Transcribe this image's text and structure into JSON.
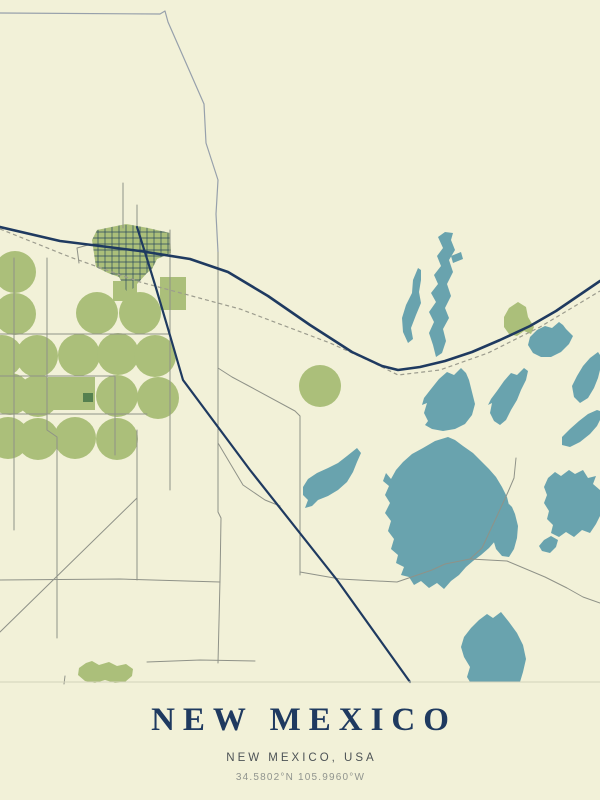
{
  "poster": {
    "title": "NEW MEXICO",
    "subtitle": "NEW MEXICO, USA",
    "coordinates": "34.5802°N 105.9960°W"
  },
  "colors": {
    "bg": "#f2f1d8",
    "lake": "#69a3ae",
    "field": "#abbf7a",
    "fieldDark": "#55804f",
    "highway": "#1f3a60",
    "railway": "#9c9c8e",
    "roadThin": "#8f9288",
    "roadFaint": "#d3d2ba",
    "boundary": "#97a0ab",
    "townGrid": "#2c4a5e",
    "title": "#1f3a60",
    "subtitle": "#4d5356",
    "coords": "#90948e"
  },
  "map": {
    "viewbox": "0 0 600 690",
    "town_path": "M92,240 L97,230 L126,224 L148,228 L170,233 L171,253 L157,259 L152,269 L147,273 L128,294 L119,277 L108,273 L96,267 Z",
    "features": [
      {
        "layer": "fields",
        "type": "path",
        "name": "town-area",
        "cls": "f-field",
        "d": "M92,240 L97,230 L126,224 L148,228 L170,233 L171,253 L157,259 L152,269 L147,273 L128,294 L119,277 L108,273 L96,267 Z"
      },
      {
        "layer": "fields",
        "type": "circle",
        "name": "crop-circle",
        "cls": "f-field",
        "cx": 15,
        "cy": 272,
        "r": 21
      },
      {
        "layer": "fields",
        "type": "circle",
        "name": "crop-circle",
        "cls": "f-field",
        "cx": 15,
        "cy": 314,
        "r": 21
      },
      {
        "layer": "fields",
        "type": "circle",
        "name": "crop-circle",
        "cls": "f-field",
        "cx": 97,
        "cy": 313,
        "r": 21
      },
      {
        "layer": "fields",
        "type": "circle",
        "name": "crop-circle",
        "cls": "f-field",
        "cx": 140,
        "cy": 313,
        "r": 21
      },
      {
        "layer": "fields",
        "type": "circle",
        "name": "crop-circle",
        "cls": "f-field",
        "cx": 2,
        "cy": 356,
        "r": 21
      },
      {
        "layer": "fields",
        "type": "circle",
        "name": "crop-circle",
        "cls": "f-field",
        "cx": 37,
        "cy": 356,
        "r": 21
      },
      {
        "layer": "fields",
        "type": "circle",
        "name": "crop-circle",
        "cls": "f-field",
        "cx": 79,
        "cy": 355,
        "r": 21
      },
      {
        "layer": "fields",
        "type": "circle",
        "name": "crop-circle",
        "cls": "f-field",
        "cx": 118,
        "cy": 354,
        "r": 21
      },
      {
        "layer": "fields",
        "type": "circle",
        "name": "crop-circle",
        "cls": "f-field",
        "cx": 155,
        "cy": 356,
        "r": 21
      },
      {
        "layer": "fields",
        "type": "circle",
        "name": "crop-circle",
        "cls": "f-field",
        "cx": 10,
        "cy": 394,
        "r": 21
      },
      {
        "layer": "fields",
        "type": "circle",
        "name": "crop-circle",
        "cls": "f-field",
        "cx": 38,
        "cy": 396,
        "r": 21
      },
      {
        "layer": "fields",
        "type": "circle",
        "name": "crop-circle",
        "cls": "f-field",
        "cx": 117,
        "cy": 396,
        "r": 21
      },
      {
        "layer": "fields",
        "type": "circle",
        "name": "crop-circle",
        "cls": "f-field",
        "cx": 158,
        "cy": 398,
        "r": 21
      },
      {
        "layer": "fields",
        "type": "circle",
        "name": "crop-circle",
        "cls": "f-field",
        "cx": 8,
        "cy": 438,
        "r": 21
      },
      {
        "layer": "fields",
        "type": "circle",
        "name": "crop-circle",
        "cls": "f-field",
        "cx": 38,
        "cy": 439,
        "r": 21
      },
      {
        "layer": "fields",
        "type": "circle",
        "name": "crop-circle",
        "cls": "f-field",
        "cx": 75,
        "cy": 438,
        "r": 21
      },
      {
        "layer": "fields",
        "type": "circle",
        "name": "crop-circle",
        "cls": "f-field",
        "cx": 117,
        "cy": 439,
        "r": 21
      },
      {
        "layer": "fields",
        "type": "circle",
        "name": "crop-circle",
        "cls": "f-field",
        "cx": 320,
        "cy": 386,
        "r": 21
      },
      {
        "layer": "fields",
        "type": "path",
        "name": "field-patch",
        "cls": "f-field",
        "d": "M48,377 H95 V410 H48 Z"
      },
      {
        "layer": "fields",
        "type": "path",
        "name": "field-patch",
        "cls": "f-field",
        "d": "M160,277 H186 V310 H160 Z"
      },
      {
        "layer": "fields",
        "type": "path",
        "name": "field-patch",
        "cls": "f-field",
        "d": "M113,281 H137 V301 H113 Z"
      },
      {
        "layer": "fields",
        "type": "path",
        "name": "field-patch",
        "cls": "f-field",
        "d": "M518,302 L509,308 L504,317 L504,327 L509,334 L517,336 L524,331 L531,334 L534,327 L528,317 L526,307 Z"
      },
      {
        "layer": "fields",
        "type": "path",
        "name": "field-patch",
        "cls": "f-field",
        "d": "M86,663 L79,668 L78,675 L85,681 L95,683 L105,680 L115,683 L125,682 L132,676 L133,669 L126,664 L117,666 L109,662 L99,665 L92,661 Z"
      },
      {
        "layer": "fields",
        "type": "path",
        "name": "field-patch-dark",
        "cls": "f-fielddark",
        "d": "M83,393 H93 V402 H83 Z"
      },
      {
        "layer": "grid",
        "type": "path",
        "name": "town-street-grid",
        "cls": "s-grid",
        "clip": true,
        "d": "M98,225 V296 M105,225 V296 M112,225 V296 M119,225 V296 M126,225 V296 M133,225 V296 M140,225 V296 M147,225 V296 M154,225 V296 M161,225 V296 M168,225 V296 M90,232 H174 M90,238 H174 M90,244 H174 M90,250 H174 M90,256 H174 M90,262 H174 M90,268 H174 M90,274 H174 M90,280 H174"
      },
      {
        "layer": "lakes",
        "type": "path",
        "name": "lake",
        "cls": "f-lake",
        "d": "M418,268 L413,280 L412,293 L406,305 L402,318 L403,332 L408,343 L413,339 L411,328 L416,315 L421,303 L419,292 L421,280 L421,270 Z"
      },
      {
        "layer": "lakes",
        "type": "path",
        "name": "lake",
        "cls": "f-lake",
        "d": "M445,232 L438,237 L443,248 L437,256 L441,266 L434,275 L438,284 L431,293 L436,302 L429,312 L434,322 L429,333 L433,345 L436,357 L442,353 L446,341 L443,329 L449,318 L445,308 L451,296 L447,284 L453,272 L449,260 L455,250 L451,240 L453,233 Z"
      },
      {
        "layer": "lakes",
        "type": "path",
        "name": "lake",
        "cls": "f-lake",
        "d": "M451,256 L461,252 L463,259 L453,263 Z"
      },
      {
        "layer": "lakes",
        "type": "path",
        "name": "lake",
        "cls": "f-lake",
        "d": "M461,368 L454,375 L447,372 L439,379 L431,389 L424,398 L422,405 L427,403 L424,413 L428,421 L425,425 L432,429 L443,431 L455,429 L465,424 L472,415 L475,404 L472,392 L469,380 L466,373 Z"
      },
      {
        "layer": "lakes",
        "type": "path",
        "name": "lake",
        "cls": "f-lake",
        "d": "M524,368 L517,375 L511,373 L504,381 L497,391 L491,399 L488,405 L492,403 L490,413 L494,421 L500,425 L506,420 L511,410 L517,400 L521,390 L526,380 L528,371 Z"
      },
      {
        "layer": "lakes",
        "type": "path",
        "name": "lake",
        "cls": "f-lake",
        "d": "M559,322 L552,328 L545,326 L537,330 L530,337 L528,345 L533,353 L541,357 L551,357 L561,352 L569,344 L573,336 L566,329 L563,325 Z"
      },
      {
        "layer": "lakes",
        "type": "path",
        "name": "lake",
        "cls": "f-lake",
        "d": "M598,352 L590,358 L583,366 L577,376 L572,386 L574,397 L580,403 L588,398 L594,388 L598,378 L600,370 L600,355 Z"
      },
      {
        "layer": "lakes",
        "type": "path",
        "name": "lake",
        "cls": "f-lake",
        "d": "M597,410 L588,414 L579,421 L570,429 L562,437 L562,445 L570,447 L580,442 L590,434 L597,426 L600,420 L600,411 Z"
      },
      {
        "layer": "lakes",
        "type": "path",
        "name": "lake",
        "cls": "f-lake",
        "d": "M357,448 L347,456 L338,463 L328,468 L317,473 L308,479 L303,487 L303,495 L308,500 L305,508 L312,506 L318,500 L328,496 L338,490 L347,482 L353,472 L357,462 L361,453 Z"
      },
      {
        "layer": "lakes",
        "type": "path",
        "name": "lake",
        "cls": "f-lake",
        "d": "M448,437 L435,441 L423,448 L412,454 L403,462 L396,470 L391,479 L386,473 L383,481 L389,486 L385,495 L390,503 L385,513 L391,521 L388,531 L394,539 L391,549 L398,555 L396,563 L404,567 L401,575 L409,577 L414,585 L421,581 L429,588 L437,583 L444,589 L451,581 L459,575 L466,567 L473,561 L481,555 L489,548 L496,540 L503,531 L508,521 L510,509 L507,497 L502,487 L496,477 L489,469 L481,461 L473,453 L463,446 L455,440 Z"
      },
      {
        "layer": "lakes",
        "type": "path",
        "name": "lake",
        "cls": "f-lake",
        "d": "M509,504 L503,511 L498,519 L494,529 L493,539 L496,549 L502,556 L509,557 L514,549 L517,538 L518,526 L515,514 L512,507 Z"
      },
      {
        "layer": "lakes",
        "type": "path",
        "name": "lake",
        "cls": "f-lake",
        "d": "M569,470 L561,476 L555,472 L548,478 L544,487 L547,495 L544,503 L549,511 L547,519 L553,525 L551,533 L559,537 L566,532 L574,537 L582,530 L590,533 L596,524 L600,516 L600,490 L593,484 L596,476 L588,478 L583,470 L575,474 Z"
      },
      {
        "layer": "lakes",
        "type": "path",
        "name": "lake",
        "cls": "f-lake",
        "d": "M551,536 L544,540 L539,546 L542,551 L550,553 L556,547 L558,540 Z"
      },
      {
        "layer": "lakes",
        "type": "path",
        "name": "lake",
        "cls": "f-lake",
        "d": "M501,612 L493,618 L487,614 L479,620 L471,628 L464,637 L461,647 L464,657 L470,667 L467,677 L470,682 L520,682 L523,672 L526,659 L523,645 L517,633 L509,622 Z"
      },
      {
        "layer": "roads",
        "type": "path",
        "name": "street",
        "cls": "s-thin",
        "d": "M123,183 V228"
      },
      {
        "layer": "roads",
        "type": "path",
        "name": "street",
        "cls": "s-thin",
        "d": "M137,205 V228"
      },
      {
        "layer": "roads",
        "type": "path",
        "name": "street",
        "cls": "s-thin",
        "d": "M88,245 L77,248 L79,263"
      },
      {
        "layer": "roads",
        "type": "path",
        "name": "section-road",
        "cls": "s-thin",
        "d": "M218,252 L218,512 L221,518 L220,580 L218,663"
      },
      {
        "layer": "roads",
        "type": "path",
        "name": "section-road",
        "cls": "s-thin",
        "d": "M218,368 L232,377 L247,385 L295,411 L300,416 L300,575"
      },
      {
        "layer": "roads",
        "type": "path",
        "name": "section-road",
        "cls": "s-thin",
        "d": "M218,443 L243,485 L265,500 L280,506"
      },
      {
        "layer": "roads",
        "type": "path",
        "name": "section-road",
        "cls": "s-thin",
        "d": "M0,334 H170"
      },
      {
        "layer": "roads",
        "type": "path",
        "name": "section-road",
        "cls": "s-thin",
        "d": "M0,376 H115"
      },
      {
        "layer": "roads",
        "type": "path",
        "name": "section-road",
        "cls": "s-thin",
        "d": "M0,414 H147"
      },
      {
        "layer": "roads",
        "type": "path",
        "name": "section-road",
        "cls": "s-thin",
        "d": "M115,377 V455"
      },
      {
        "layer": "roads",
        "type": "path",
        "name": "section-road",
        "cls": "s-thin",
        "d": "M137,430 V580"
      },
      {
        "layer": "roads",
        "type": "path",
        "name": "section-road",
        "cls": "s-thin",
        "d": "M14,258 V530"
      },
      {
        "layer": "roads",
        "type": "path",
        "name": "section-road",
        "cls": "s-thin",
        "d": "M47,258 V430 L57,437 V638"
      },
      {
        "layer": "roads",
        "type": "path",
        "name": "section-road",
        "cls": "s-thin",
        "d": "M170,230 V490"
      },
      {
        "layer": "roads",
        "type": "path",
        "name": "section-road",
        "cls": "s-thin",
        "d": "M0,580 L120,579 L220,582"
      },
      {
        "layer": "roads",
        "type": "path",
        "name": "section-road",
        "cls": "s-thin",
        "d": "M137,498 L0,632"
      },
      {
        "layer": "roads",
        "type": "path",
        "name": "section-road",
        "cls": "s-thin",
        "d": "M147,662 L200,660 L255,661"
      },
      {
        "layer": "roads",
        "type": "path",
        "name": "rural-road",
        "cls": "s-thin",
        "d": "M300,572 L340,579 L397,582 L432,570 L445,564 L470,559 L482,548 L497,516 L508,492 L514,478 L516,458"
      },
      {
        "layer": "roads",
        "type": "path",
        "name": "rural-road",
        "cls": "s-thin",
        "d": "M470,559 L507,561 L545,577 L567,588 L583,597 L600,603"
      },
      {
        "layer": "roads",
        "type": "path",
        "name": "rural-road",
        "cls": "s-thin",
        "d": "M65,676 L64,684"
      },
      {
        "layer": "roads",
        "type": "path",
        "name": "boundary-line",
        "cls": "s-boundary",
        "d": "M0,13 L160,14 L165,11 L168,22 L204,104 L206,143 L218,180 L216,214 L218,252"
      },
      {
        "layer": "rail",
        "type": "path",
        "name": "railway-line",
        "cls": "s-rail",
        "d": "M0,229 L70,257 L140,282 L240,309 L330,343 L372,362 L398,375 L440,370 L488,353 L540,327 L600,291"
      },
      {
        "layer": "highways",
        "type": "path",
        "name": "highway",
        "cls": "s-hwy",
        "d": "M0,227 L60,241 L140,251 L190,259 L228,272 L268,296 L310,325 L352,352 L382,366 L398,370 L420,367 L445,361 L472,352 L500,340 L530,326 L556,311 L578,296 L600,281"
      },
      {
        "layer": "highways",
        "type": "path",
        "name": "highway",
        "cls": "s-hwy2",
        "d": "M137,227 L148,262 L156,288 L169,332 L183,380 L250,470 L337,580 L410,682"
      },
      {
        "layer": "edge",
        "type": "path",
        "name": "map-edge-line",
        "cls": "s-faint",
        "d": "M0,682 H600"
      }
    ]
  }
}
